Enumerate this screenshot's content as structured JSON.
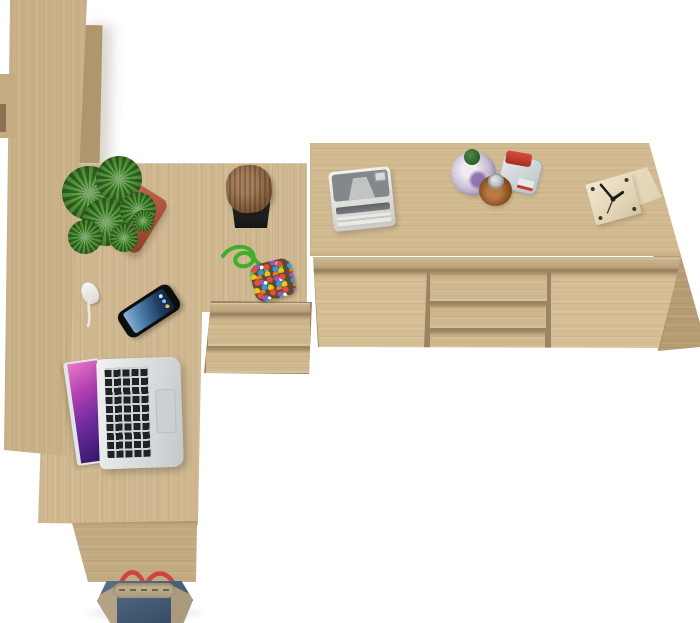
{
  "scene": {
    "description": "Top-down 3D product render of a Sonoma oak home office furniture set on a white background",
    "background_color": "#ffffff"
  },
  "palette": {
    "oak_light": "#d5bd94",
    "oak_mid": "#cfb890",
    "oak_dark": "#b69c72",
    "seam_shadow": "#9b8560",
    "pot_red": "#b25640",
    "plant_green": "#4e8a3a",
    "strap_red": "#cc4348",
    "denim_blue": "#49607b"
  },
  "furniture": {
    "bookcase": {
      "label": "Tall bookcase seen from above (left edge)"
    },
    "desk": {
      "label": "L-shaped desk top"
    },
    "desk_panel": {
      "label": "Desk front panel"
    },
    "pedestal": {
      "label": "Under-desk drawer pedestal",
      "drawer_count": 2
    },
    "sideboard": {
      "label": "Sideboard with left door, three center drawers and right door",
      "drawer_count": 3,
      "door_count": 2
    }
  },
  "items": [
    {
      "id": "succulent-plant",
      "label": "Succulent in red clay pot",
      "colors": [
        "#4e8a3a",
        "#b25640"
      ]
    },
    {
      "id": "wood-stump",
      "label": "Decorative wood stump on black stand"
    },
    {
      "id": "bead-keychain",
      "label": "Multicolored bead pouch with green cord"
    },
    {
      "id": "smartphone",
      "label": "Smartphone with blue screen"
    },
    {
      "id": "earbuds",
      "label": "White earbuds with cable"
    },
    {
      "id": "laptop",
      "label": "Open silver laptop with purple wallpaper"
    },
    {
      "id": "printer",
      "label": "Compact white printer"
    },
    {
      "id": "bottles",
      "label": "Three glass bottles",
      "details": [
        "green cap",
        "red cap",
        "amber with silver cap"
      ]
    },
    {
      "id": "cube-clock",
      "label": "Wooden cube desk clock"
    },
    {
      "id": "tote-bag",
      "label": "Denim tote bag with red straps"
    }
  ]
}
